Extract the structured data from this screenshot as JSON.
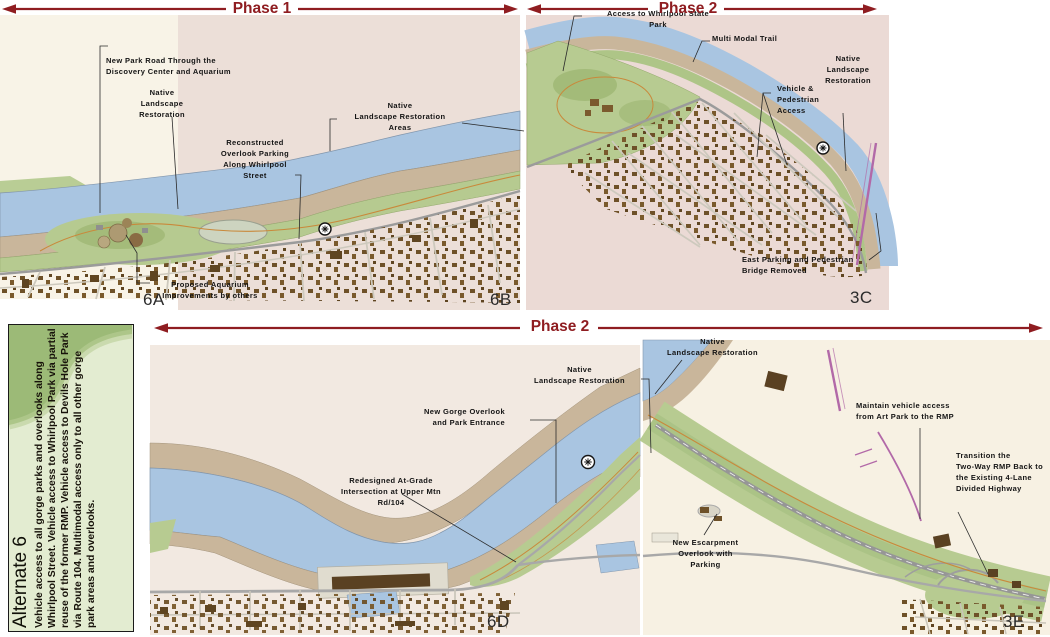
{
  "palette": {
    "arrow": "#8f1d21",
    "river": "#a9c5e1",
    "parkland": "#b6ca90",
    "gorge_bank": "#c9b69b",
    "phase_tint": "#ecdfd8",
    "panel_green": "#9fbd77"
  },
  "phases": {
    "phase1_label": "Phase 1",
    "phase2_top_label": "Phase 2",
    "phase2_bottom_label": "Phase 2"
  },
  "alternate_panel": {
    "title": "Alternate 6",
    "description": "Vehicle access to all gorge parks and overlooks along Whirlpool Street. Vehicle access to Whirlpool Park via partial reuse of the former RMP. Vehicle access to Devils Hole Park via Route 104. Multimodal access only to all other gorge park areas and overlooks."
  },
  "top_map": {
    "section_labels": [
      "6A",
      "6B",
      "3C"
    ],
    "annotations": [
      {
        "id": "new-park-road",
        "text": "New Park Road Through the\nDiscovery Center and Aquarium"
      },
      {
        "id": "native-landscape-restoration-west",
        "text": "Native\nLandscape\nRestoration"
      },
      {
        "id": "reconstructed-overlook-parking",
        "text": "Reconstructed\nOverlook Parking\nAlong Whirlpool\nStreet"
      },
      {
        "id": "native-landscape-restoration-areas",
        "text": "Native\nLandscape Restoration\nAreas"
      },
      {
        "id": "access-whirlpool-state-park",
        "text": "Access to Whirlpool State\nPark"
      },
      {
        "id": "multi-modal-trail",
        "text": "Multi Modal Trail"
      },
      {
        "id": "native-landscape-restoration-east",
        "text": "Native\nLandscape\nRestoration"
      },
      {
        "id": "vehicle-pedestrian-access",
        "text": "Vehicle &\nPedestrian\nAccess"
      },
      {
        "id": "east-parking-bridge-removed",
        "text": "East Parking and Pedestrian\nBridge Removed"
      },
      {
        "id": "proposed-aquarium-improvements",
        "text": "Proposed Aquarium\nImprovements by others"
      }
    ]
  },
  "bottom_map": {
    "section_labels": [
      "6D",
      "3E"
    ],
    "annotations": [
      {
        "id": "native-landscape-restoration-upper",
        "text": "Native\nLandscape Restoration"
      },
      {
        "id": "native-landscape-restoration-lower",
        "text": "Native\nLandscape Restoration"
      },
      {
        "id": "new-gorge-overlook",
        "text": "New Gorge Overlook\nand Park Entrance"
      },
      {
        "id": "redesigned-at-grade-intersection",
        "text": "Redesigned At-Grade\nIntersection at Upper Mtn\nRd/104"
      },
      {
        "id": "maintain-vehicle-access",
        "text": "Maintain vehicle access\nfrom Art Park to the RMP"
      },
      {
        "id": "transition-two-way-rmp",
        "text": "Transition the\nTwo-Way RMP Back to\nthe Existing 4-Lane\nDivided Highway"
      },
      {
        "id": "new-escarpment-overlook",
        "text": "New Escarpment\nOverlook with\nParking"
      }
    ]
  }
}
